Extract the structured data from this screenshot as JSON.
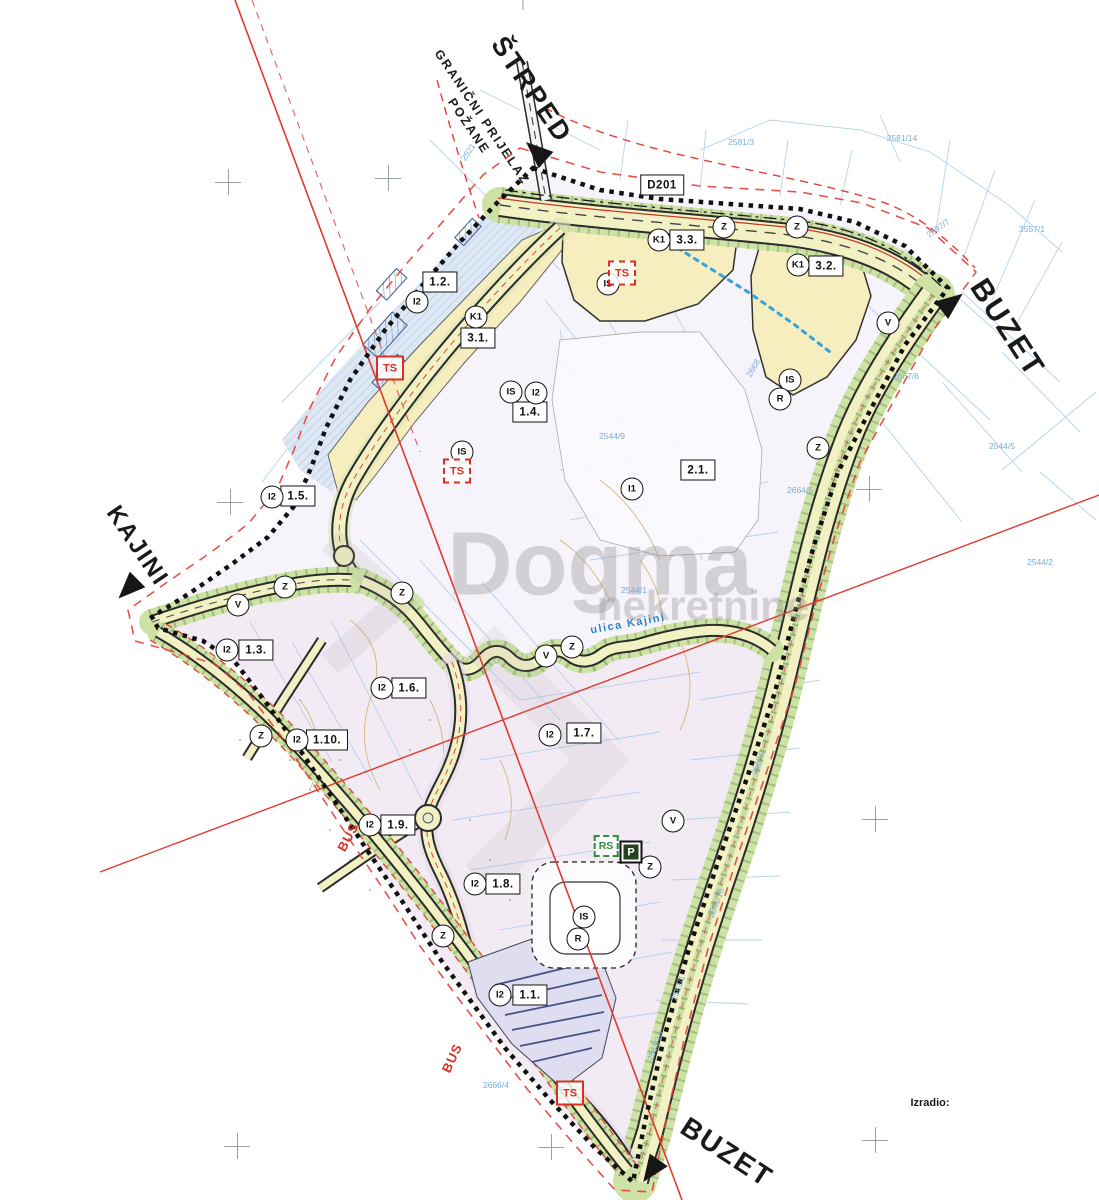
{
  "map": {
    "colors": {
      "plan_boundary": "#111111",
      "boundary_offset_red": "#E24036",
      "road_fill": "#F2F1C3",
      "green_strip": "#CFE2A5",
      "zone_commercial_yellow": "#F6EEBE",
      "zone_industrial_lavender": "#F2E9F2",
      "zone_existing_blue": "#DEE8F5",
      "cadastral_blue": "#AECDE9",
      "marker_red": "#D93025",
      "utility_blue": "#35A3DC"
    },
    "markers": [
      {
        "type": "direction",
        "name": "label-strped",
        "label": "ŠTRPED",
        "x": 531,
        "y": 90,
        "rot": 56,
        "size": 27
      },
      {
        "type": "direction",
        "name": "label-granicni-prijelaz",
        "label": "GRANIČNI PRIJELAZ\nPOŽANE",
        "x": 475,
        "y": 122,
        "rot": 56,
        "size": 12.5
      },
      {
        "type": "direction",
        "name": "label-buzet-east",
        "label": "BUZET",
        "x": 1007,
        "y": 328,
        "rot": 57,
        "size": 30
      },
      {
        "type": "direction",
        "name": "label-kajini",
        "label": "KAJINI",
        "x": 137,
        "y": 546,
        "rot": 56,
        "size": 24
      },
      {
        "type": "direction",
        "name": "label-buzet-south",
        "label": "BUZET",
        "x": 727,
        "y": 1152,
        "rot": 33,
        "size": 28
      },
      {
        "type": "credit",
        "name": "label-izradio",
        "label": "Izradio:",
        "x": 930,
        "y": 1103
      },
      {
        "type": "arrow",
        "name": "arrow-strped",
        "x": 536,
        "y": 151,
        "rot": -48
      },
      {
        "type": "arrow",
        "name": "arrow-buzet-east",
        "x": 952,
        "y": 302,
        "rot": 52
      },
      {
        "type": "arrow",
        "name": "arrow-kajini",
        "x": 128,
        "y": 589,
        "rot": -135
      },
      {
        "type": "arrow",
        "name": "arrow-buzet-south",
        "x": 651,
        "y": 1171,
        "rot": -145
      },
      {
        "type": "zone-box",
        "name": "road-ref-d201",
        "label": "D201",
        "x": 662,
        "y": 185
      },
      {
        "type": "zone-box",
        "name": "zone-box-1-2",
        "label": "1.2.",
        "x": 440,
        "y": 282
      },
      {
        "type": "zone-box",
        "name": "zone-box-3-1",
        "label": "3.1.",
        "x": 478,
        "y": 338
      },
      {
        "type": "zone-box",
        "name": "zone-box-1-4",
        "label": "1.4.",
        "x": 530,
        "y": 412
      },
      {
        "type": "zone-box",
        "name": "zone-box-1-5",
        "label": "1.5.",
        "x": 298,
        "y": 496
      },
      {
        "type": "zone-box",
        "name": "zone-box-1-3",
        "label": "1.3.",
        "x": 256,
        "y": 650
      },
      {
        "type": "zone-box",
        "name": "zone-box-1-6",
        "label": "1.6.",
        "x": 409,
        "y": 688
      },
      {
        "type": "zone-box",
        "name": "zone-box-1-10",
        "label": "1.10.",
        "x": 327,
        "y": 740
      },
      {
        "type": "zone-box",
        "name": "zone-box-1-7",
        "label": "1.7.",
        "x": 584,
        "y": 733
      },
      {
        "type": "zone-box",
        "name": "zone-box-1-9",
        "label": "1.9.",
        "x": 398,
        "y": 825
      },
      {
        "type": "zone-box",
        "name": "zone-box-1-8",
        "label": "1.8.",
        "x": 503,
        "y": 884
      },
      {
        "type": "zone-box",
        "name": "zone-box-1-1",
        "label": "1.1.",
        "x": 530,
        "y": 995
      },
      {
        "type": "zone-box",
        "name": "zone-box-2-1",
        "label": "2.1.",
        "x": 698,
        "y": 470
      },
      {
        "type": "zone-box",
        "name": "zone-box-3-3",
        "label": "3.3.",
        "x": 687,
        "y": 240
      },
      {
        "type": "zone-box",
        "name": "zone-box-3-2",
        "label": "3.2.",
        "x": 826,
        "y": 266
      },
      {
        "type": "zone-circle",
        "name": "zone-circle-k1-a",
        "label": "K1",
        "x": 476,
        "y": 317
      },
      {
        "type": "zone-circle",
        "name": "zone-circle-k1-b",
        "label": "K1",
        "x": 659,
        "y": 240
      },
      {
        "type": "zone-circle",
        "name": "zone-circle-k1-c",
        "label": "K1",
        "x": 798,
        "y": 265
      },
      {
        "type": "zone-circle",
        "name": "zone-circle-i2-a",
        "label": "I2",
        "x": 417,
        "y": 302
      },
      {
        "type": "zone-circle",
        "name": "zone-circle-i2-b",
        "label": "I2",
        "x": 536,
        "y": 393
      },
      {
        "type": "zone-circle",
        "name": "zone-circle-i2-c",
        "label": "I2",
        "x": 272,
        "y": 497
      },
      {
        "type": "zone-circle",
        "name": "zone-circle-i2-d",
        "label": "I2",
        "x": 227,
        "y": 650
      },
      {
        "type": "zone-circle",
        "name": "zone-circle-i2-e",
        "label": "I2",
        "x": 382,
        "y": 688
      },
      {
        "type": "zone-circle",
        "name": "zone-circle-i2-f",
        "label": "I2",
        "x": 297,
        "y": 740
      },
      {
        "type": "zone-circle",
        "name": "zone-circle-i2-g",
        "label": "I2",
        "x": 550,
        "y": 735
      },
      {
        "type": "zone-circle",
        "name": "zone-circle-i2-h",
        "label": "I2",
        "x": 370,
        "y": 825
      },
      {
        "type": "zone-circle",
        "name": "zone-circle-i2-i",
        "label": "I2",
        "x": 475,
        "y": 884
      },
      {
        "type": "zone-circle",
        "name": "zone-circle-i2-j",
        "label": "I2",
        "x": 500,
        "y": 995
      },
      {
        "type": "zone-circle",
        "name": "zone-circle-i1",
        "label": "I1",
        "x": 632,
        "y": 489
      },
      {
        "type": "zone-circle",
        "name": "zone-circle-is-a",
        "label": "IS",
        "x": 608,
        "y": 284
      },
      {
        "type": "zone-circle",
        "name": "zone-circle-is-b",
        "label": "IS",
        "x": 511,
        "y": 392
      },
      {
        "type": "zone-circle",
        "name": "zone-circle-is-c",
        "label": "IS",
        "x": 462,
        "y": 452
      },
      {
        "type": "zone-circle",
        "name": "zone-circle-is-d",
        "label": "IS",
        "x": 790,
        "y": 380
      },
      {
        "type": "zone-circle",
        "name": "zone-circle-is-e",
        "label": "IS",
        "x": 584,
        "y": 917
      },
      {
        "type": "zone-circle",
        "name": "zone-circle-r-a",
        "label": "R",
        "x": 780,
        "y": 399
      },
      {
        "type": "zone-circle",
        "name": "zone-circle-r-b",
        "label": "R",
        "x": 578,
        "y": 939
      },
      {
        "type": "zone-circle",
        "name": "zone-circle-z-a",
        "label": "Z",
        "x": 724,
        "y": 227
      },
      {
        "type": "zone-circle",
        "name": "zone-circle-z-b",
        "label": "Z",
        "x": 797,
        "y": 227
      },
      {
        "type": "zone-circle",
        "name": "zone-circle-z-c",
        "label": "Z",
        "x": 818,
        "y": 448
      },
      {
        "type": "zone-circle",
        "name": "zone-circle-z-d",
        "label": "Z",
        "x": 285,
        "y": 587
      },
      {
        "type": "zone-circle",
        "name": "zone-circle-z-e",
        "label": "Z",
        "x": 402,
        "y": 593
      },
      {
        "type": "zone-circle",
        "name": "zone-circle-z-f",
        "label": "Z",
        "x": 572,
        "y": 647
      },
      {
        "type": "zone-circle",
        "name": "zone-circle-z-g",
        "label": "Z",
        "x": 261,
        "y": 736
      },
      {
        "type": "zone-circle",
        "name": "zone-circle-z-h",
        "label": "Z",
        "x": 650,
        "y": 867
      },
      {
        "type": "zone-circle",
        "name": "zone-circle-z-i",
        "label": "Z",
        "x": 443,
        "y": 936
      },
      {
        "type": "zone-circle",
        "name": "zone-circle-v-a",
        "label": "V",
        "x": 888,
        "y": 323
      },
      {
        "type": "zone-circle",
        "name": "zone-circle-v-b",
        "label": "V",
        "x": 238,
        "y": 605
      },
      {
        "type": "zone-circle",
        "name": "zone-circle-v-c",
        "label": "V",
        "x": 546,
        "y": 656
      },
      {
        "type": "zone-circle",
        "name": "zone-circle-v-d",
        "label": "V",
        "x": 673,
        "y": 821
      },
      {
        "type": "ts",
        "name": "ts-station-nw",
        "label": "TS",
        "x": 390,
        "y": 368,
        "variant": "solid"
      },
      {
        "type": "ts",
        "name": "ts-station-north",
        "label": "TS",
        "x": 622,
        "y": 273,
        "variant": "dashed"
      },
      {
        "type": "ts",
        "name": "ts-station-mid",
        "label": "TS",
        "x": 457,
        "y": 471,
        "variant": "dashed"
      },
      {
        "type": "ts",
        "name": "ts-station-south",
        "label": "TS",
        "x": 570,
        "y": 1093,
        "variant": "solid"
      },
      {
        "type": "rs",
        "name": "rs-box",
        "label": "RS",
        "x": 606,
        "y": 846
      },
      {
        "type": "p",
        "name": "parking-box",
        "label": "P",
        "x": 631,
        "y": 852
      },
      {
        "type": "bus",
        "name": "bus-stop-label-a",
        "label": "BUS",
        "x": 348,
        "y": 837,
        "rot": -62
      },
      {
        "type": "bus",
        "name": "bus-stop-label-b",
        "label": "BUS",
        "x": 452,
        "y": 1058,
        "rot": -65
      },
      {
        "type": "street",
        "name": "street-name-ulica-kajini",
        "label": "ulica Kajini",
        "x": 628,
        "y": 624,
        "rot": -10
      },
      {
        "type": "watermark",
        "name": "watermark-dogma",
        "label": "Dogma",
        "x": 600,
        "y": 565,
        "size": 90
      },
      {
        "type": "watermark",
        "name": "watermark-nekretnine",
        "label": "nekretnine",
        "x": 703,
        "y": 606,
        "size": 42
      },
      {
        "type": "cross",
        "name": "grid-cross-1",
        "x": 228,
        "y": 182
      },
      {
        "type": "cross",
        "name": "grid-cross-2",
        "x": 388,
        "y": 178
      },
      {
        "type": "cross",
        "name": "grid-cross-3",
        "x": 230,
        "y": 502
      },
      {
        "type": "cross",
        "name": "grid-cross-4",
        "x": 869,
        "y": 489
      },
      {
        "type": "cross",
        "name": "grid-cross-5",
        "x": 875,
        "y": 819
      },
      {
        "type": "cross",
        "name": "grid-cross-6",
        "x": 875,
        "y": 1140
      },
      {
        "type": "cross",
        "name": "grid-cross-7",
        "x": 237,
        "y": 1146
      },
      {
        "type": "cross",
        "name": "grid-cross-8",
        "x": 551,
        "y": 1147
      },
      {
        "type": "parcel",
        "name": "parcel-number",
        "label": "2521",
        "x": 468,
        "y": 152,
        "rot": -56
      },
      {
        "type": "parcel",
        "name": "parcel-number",
        "label": "2581/3",
        "x": 741,
        "y": 142
      },
      {
        "type": "parcel",
        "name": "parcel-number",
        "label": "2581/14",
        "x": 902,
        "y": 138
      },
      {
        "type": "parcel",
        "name": "parcel-number",
        "label": "2597/7",
        "x": 938,
        "y": 228,
        "rot": -35
      },
      {
        "type": "parcel",
        "name": "parcel-number",
        "label": "3557/1",
        "x": 1032,
        "y": 229
      },
      {
        "type": "parcel",
        "name": "parcel-number",
        "label": "2544/9",
        "x": 612,
        "y": 436
      },
      {
        "type": "parcel",
        "name": "parcel-number",
        "label": "2544/1",
        "x": 634,
        "y": 590
      },
      {
        "type": "parcel",
        "name": "parcel-number",
        "label": "2544/5",
        "x": 1002,
        "y": 446
      },
      {
        "type": "parcel",
        "name": "parcel-number",
        "label": "2544/2",
        "x": 1040,
        "y": 562
      },
      {
        "type": "parcel",
        "name": "parcel-number",
        "label": "2668",
        "x": 753,
        "y": 368,
        "rot": -60
      },
      {
        "type": "parcel",
        "name": "parcel-number",
        "label": "2664/5",
        "x": 800,
        "y": 490
      },
      {
        "type": "parcel",
        "name": "parcel-number",
        "label": "2667/6",
        "x": 906,
        "y": 376
      },
      {
        "type": "parcel",
        "name": "parcel-number",
        "label": "2561/1",
        "x": 678,
        "y": 988,
        "rot": -70
      },
      {
        "type": "parcel",
        "name": "parcel-number",
        "label": "2561/13",
        "x": 655,
        "y": 1046,
        "rot": -70
      },
      {
        "type": "parcel",
        "name": "parcel-number",
        "label": "2561/16",
        "x": 716,
        "y": 903,
        "rot": -70
      },
      {
        "type": "parcel",
        "name": "parcel-number",
        "label": "2669/1",
        "x": 758,
        "y": 762,
        "rot": -70
      },
      {
        "type": "parcel",
        "name": "parcel-number",
        "label": "2666/4",
        "x": 496,
        "y": 1085
      }
    ]
  }
}
